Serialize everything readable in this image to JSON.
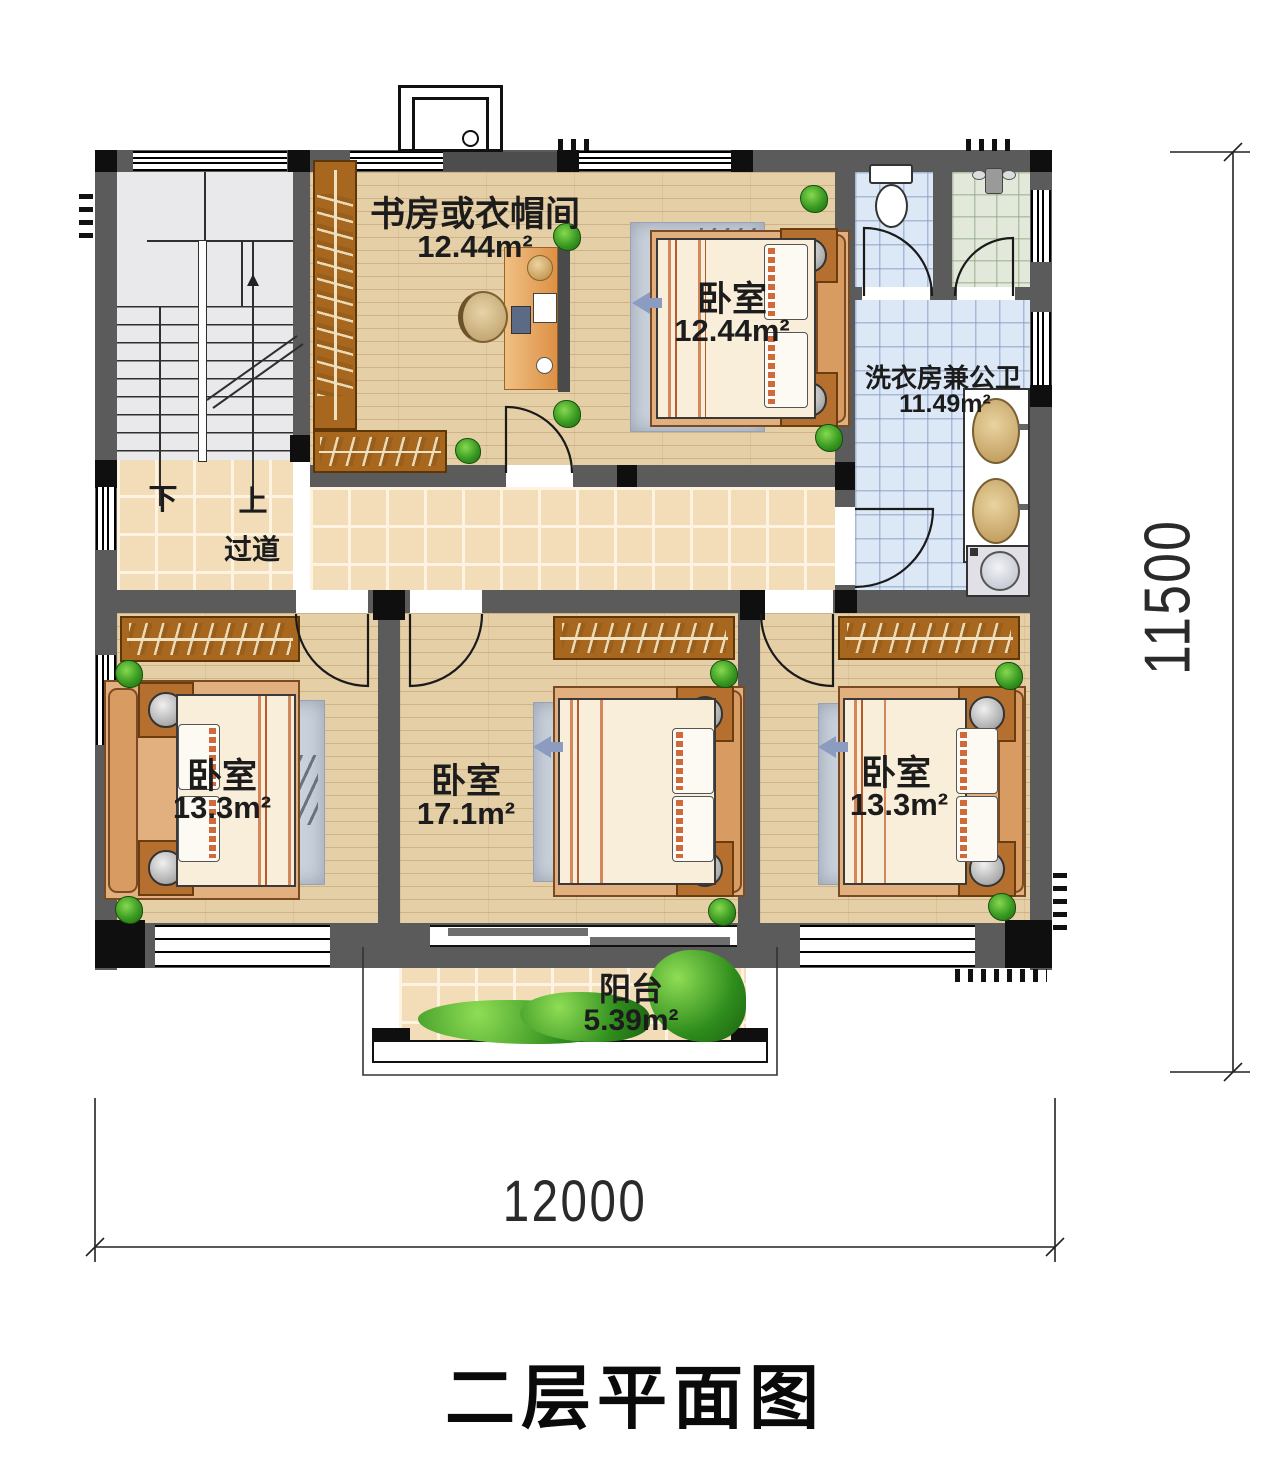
{
  "title": "二层平面图",
  "dimensions": {
    "width": "12000",
    "height": "11500"
  },
  "stairs": {
    "down": "下",
    "up": "上"
  },
  "rooms": {
    "study": {
      "name": "书房或衣帽间",
      "area": "12.44m²"
    },
    "bedroom_top": {
      "name": "卧室",
      "area": "12.44m²"
    },
    "laundry_bath": {
      "name": "洗衣房兼公卫",
      "area": "11.49m²"
    },
    "corridor": {
      "name": "过道"
    },
    "bedroom_left": {
      "name": "卧室",
      "area": "13.3m²"
    },
    "bedroom_middle": {
      "name": "卧室",
      "area": "17.1m²"
    },
    "bedroom_right": {
      "name": "卧室",
      "area": "13.3m²"
    },
    "balcony": {
      "name": "阳台",
      "area": "5.39m²"
    }
  },
  "colors": {
    "wall": "#5b5b5b",
    "column": "#0f0f0f",
    "wood_floor": "#e5cfa6",
    "corridor_tile": "#f2ddb8",
    "bath_tile": "#dde8f6",
    "shower_tile": "#e2e9da",
    "wardrobe": "#a8671f",
    "plant": "#3a9a22",
    "label_text": "#1c1c1c"
  }
}
